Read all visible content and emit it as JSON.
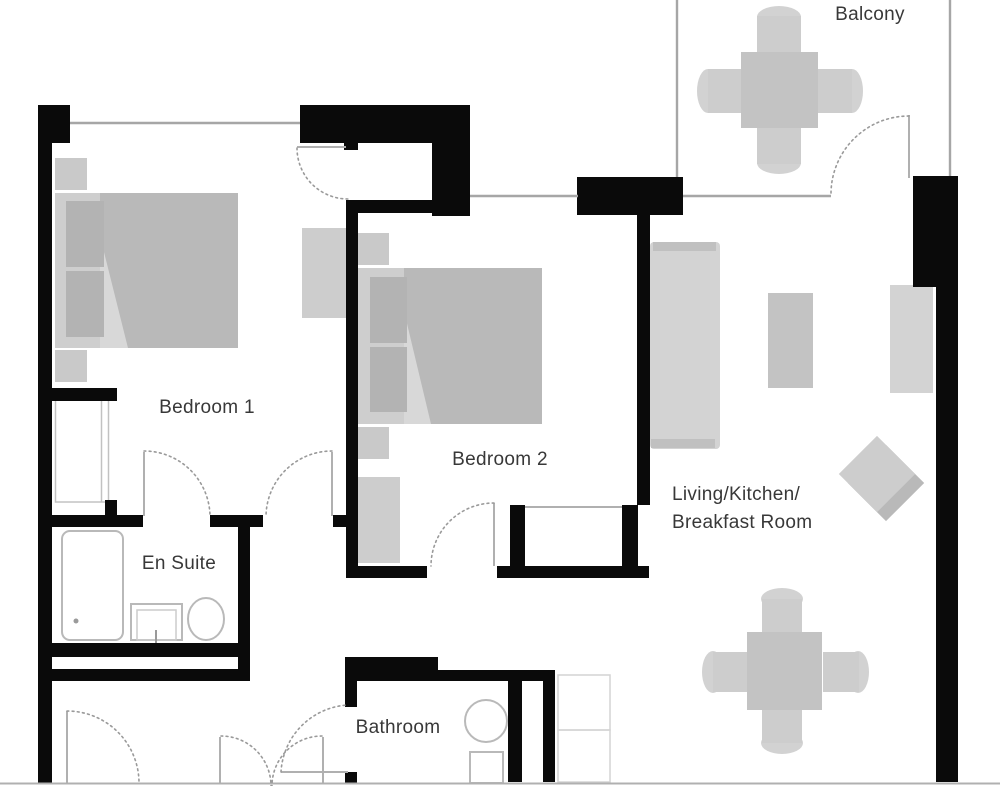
{
  "plan_title": "Apartment floor plan",
  "rooms": {
    "balcony": {
      "label": "Balcony"
    },
    "bedroom1": {
      "label": "Bedroom 1"
    },
    "bedroom2": {
      "label": "Bedroom 2"
    },
    "ensuite": {
      "label": "En Suite"
    },
    "living": {
      "line1": "Living/Kitchen/",
      "line2": "Breakfast Room"
    },
    "bathroom": {
      "label": "Bathroom"
    }
  },
  "colors": {
    "wall": "#0a0a0a",
    "window_line": "#a6a6a6",
    "door_arc": "#9a9a9a",
    "label_text": "#383838",
    "bed_duvet": "#b9b9b9",
    "bed_pillow": "#b3b3b3",
    "bed_base": "#cecece",
    "furniture_light": "#d3d3d3",
    "furniture_mid": "#c3c3c3",
    "furniture_soft": "#cdcdcd",
    "fixture_outline": "#b9b9b9",
    "bottom_rule": "#c9c9c9"
  },
  "inventory": {
    "bedroom1": [
      "double-bed",
      "nightstand",
      "nightstand",
      "wardrobe",
      "closet"
    ],
    "bedroom2": [
      "double-bed",
      "nightstand",
      "nightstand",
      "dresser",
      "built-in-wardrobe"
    ],
    "ensuite": [
      "bathtub",
      "sink",
      "toilet"
    ],
    "bathroom": [
      "toilet",
      "appliance",
      "appliance"
    ],
    "living": [
      "sofa",
      "coffee-table",
      "kitchen-counter",
      "dining-table",
      "dining-chairs",
      "side-chair"
    ],
    "balcony": [
      "outdoor-table",
      "outdoor-chairs"
    ]
  }
}
